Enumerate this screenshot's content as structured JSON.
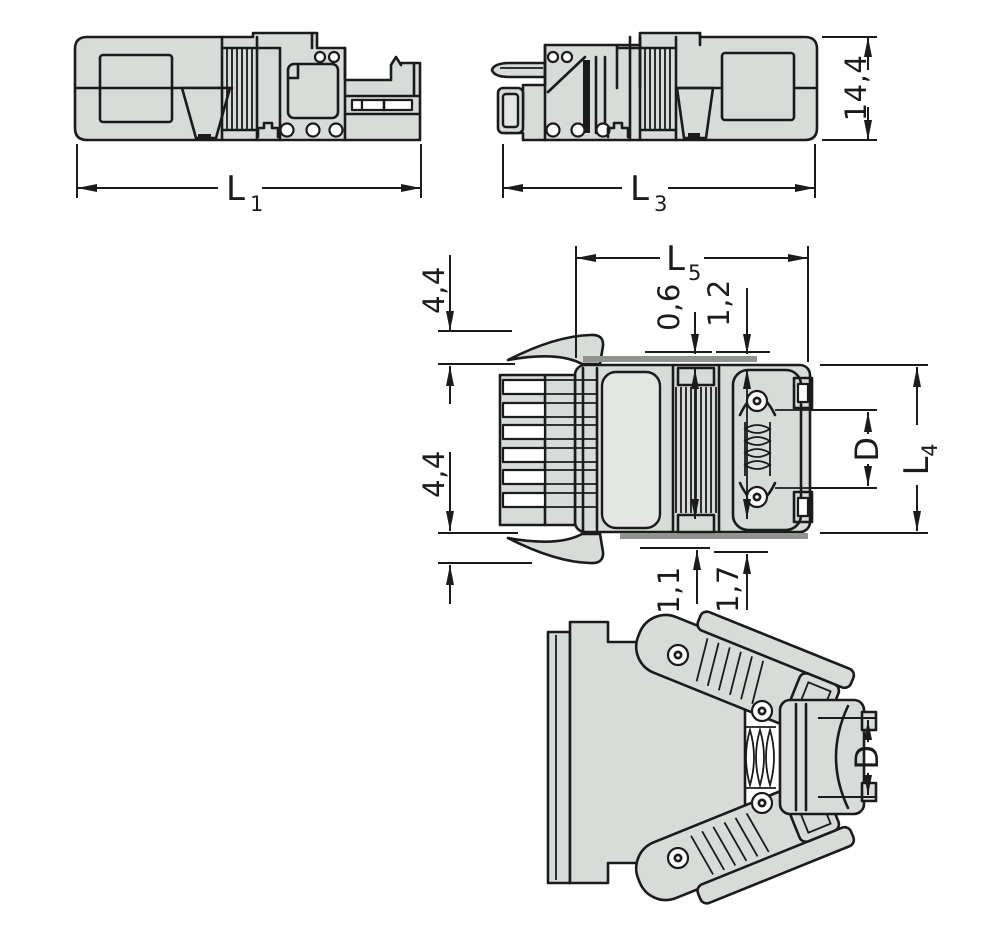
{
  "figure": {
    "type": "technical-drawing",
    "description": "Four-view dimensional drawing of an industrial connector with strain-relief housing",
    "background_color": "#ffffff",
    "line_color": "#1b1b1b",
    "body_fill_color": "#d8dcd8"
  },
  "dimensions": {
    "L1": {
      "main": "L",
      "sub": "1"
    },
    "L3": {
      "main": "L",
      "sub": "3"
    },
    "L5": {
      "main": "L",
      "sub": "5"
    },
    "L4": {
      "main": "L",
      "sub": "4"
    },
    "height_side_view": "14,4",
    "top_offset_small": "0,6",
    "top_offset_large": "1,2",
    "latch_protrusion_top": "4,4",
    "latch_protrusion_bottom": "4,4",
    "bottom_offset_small": "1,1",
    "bottom_offset_large": "1,7",
    "gland_diameter_top_view": "D",
    "gland_diameter_angled_view": "D"
  }
}
